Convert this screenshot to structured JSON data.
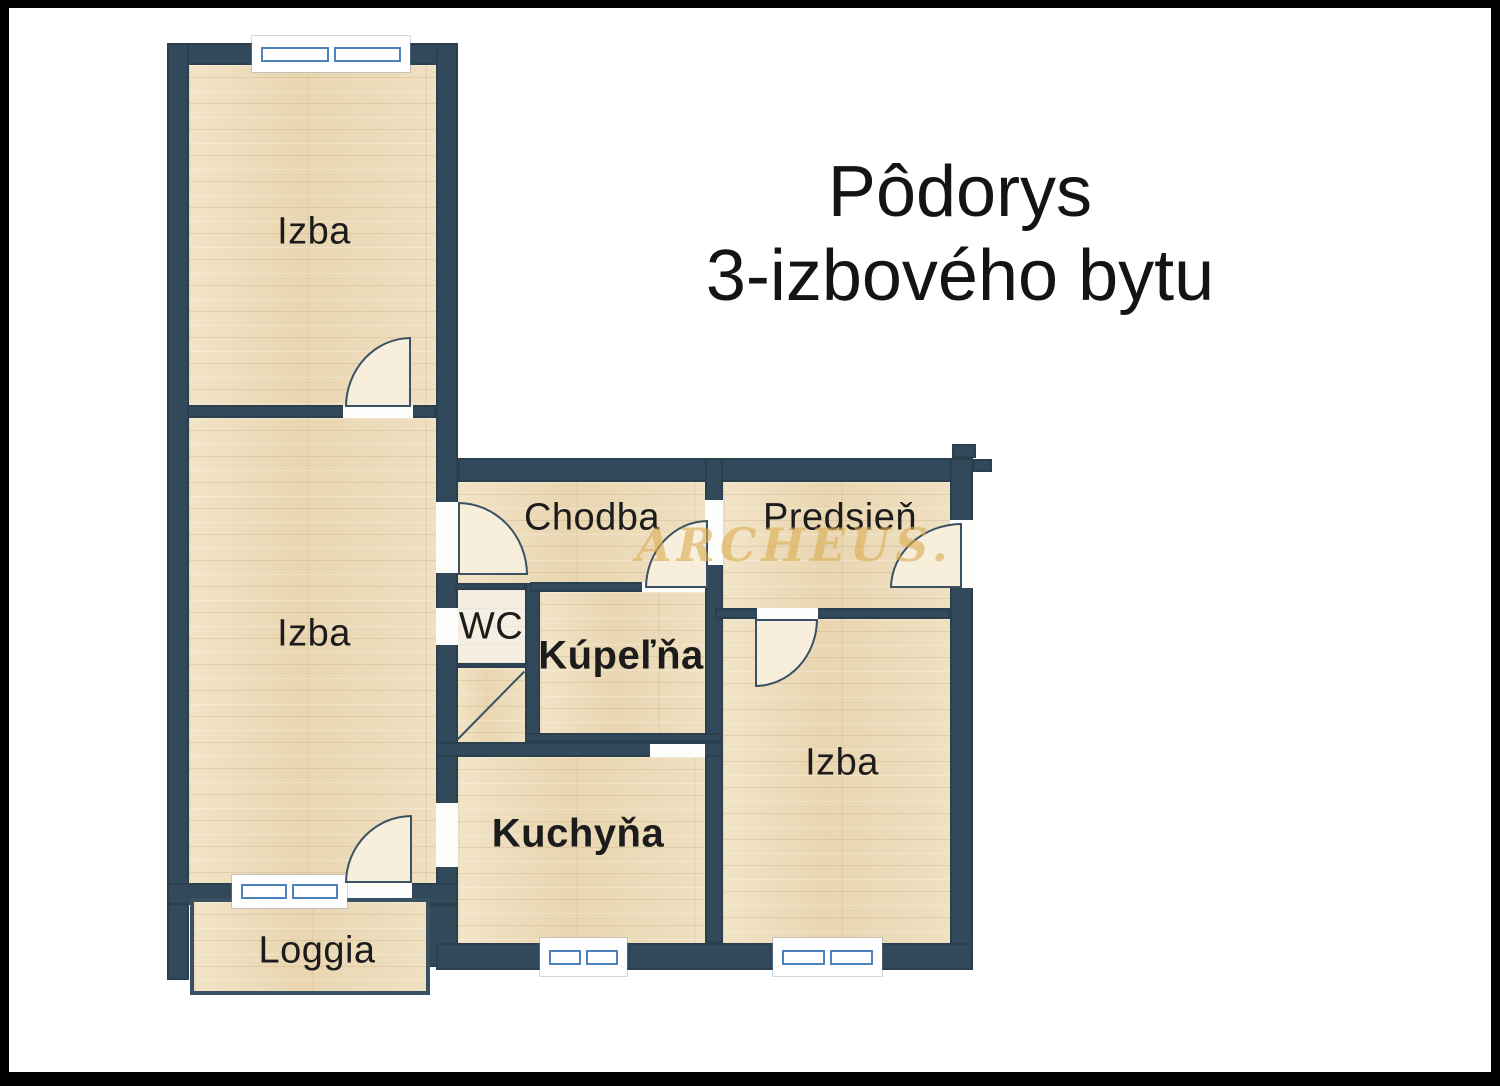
{
  "title": {
    "line1": "Pôdorys",
    "line2": "3-izbového bytu"
  },
  "watermark": "ARCHEUS.",
  "rooms": {
    "izba_top": {
      "label": "Izba"
    },
    "izba_mid": {
      "label": "Izba"
    },
    "chodba": {
      "label": "Chodba"
    },
    "predsien": {
      "label": "Predsieň"
    },
    "wc": {
      "label": "WC"
    },
    "kupelna": {
      "label": "Kúpeľňa"
    },
    "kuchyna": {
      "label": "Kuchyňa"
    },
    "izba_right": {
      "label": "Izba"
    },
    "loggia": {
      "label": "Loggia"
    }
  },
  "colors": {
    "wall": "#31495a",
    "floor_base": "#edddbb",
    "floor_light": "#f4efe2",
    "door_fill": "#f7efdc",
    "window_blue": "#4d82bd",
    "watermark_gold": "#dcae54",
    "title_text": "#141414",
    "label_text": "#1c1c1c"
  }
}
